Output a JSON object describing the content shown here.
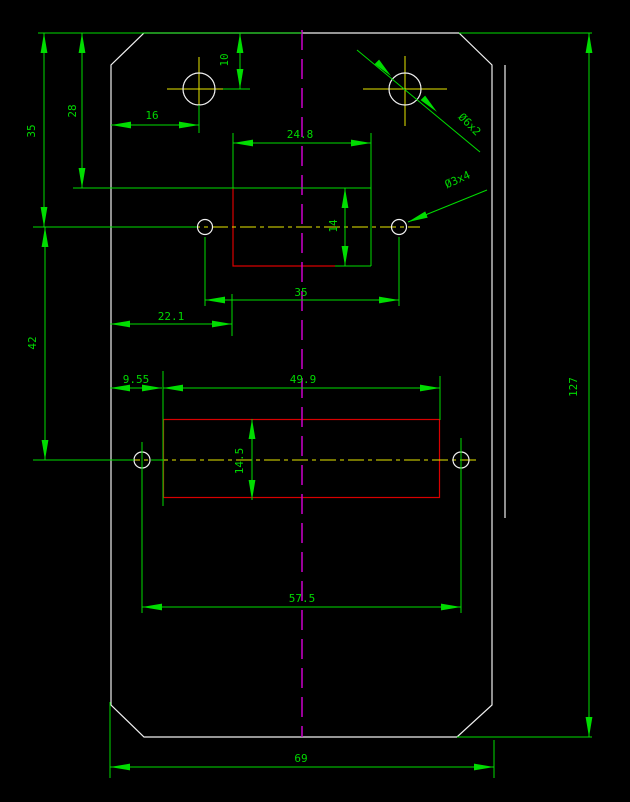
{
  "palette": {
    "background": "#000000",
    "dimension_green": "#00dc00",
    "outline_white": "#f0f0f0",
    "feature_red": "#d80000",
    "hole_centerline_yellow": "#e8e800",
    "symmetry_magenta": "#cc00cc"
  },
  "dims": {
    "top_edge_to_top_holes": "10",
    "left_edge_to_top_hole": "16",
    "top_edge_to_slot_top": "28",
    "top_edge_to_mid_holes": "35",
    "mid_holes_to_lower_holes": "42",
    "slot_width": "24.8",
    "slot_height": "14",
    "mid_holes_spacing": "35",
    "left_edge_to_slot": "22.1",
    "left_edge_to_pocket": "9.55",
    "pocket_width": "49.9",
    "pocket_height": "14.5",
    "lower_holes_spacing": "57.5",
    "part_width": "69",
    "part_height": "127",
    "top_holes_callout": "Ø6x2",
    "mid_holes_callout": "Ø3x4"
  }
}
